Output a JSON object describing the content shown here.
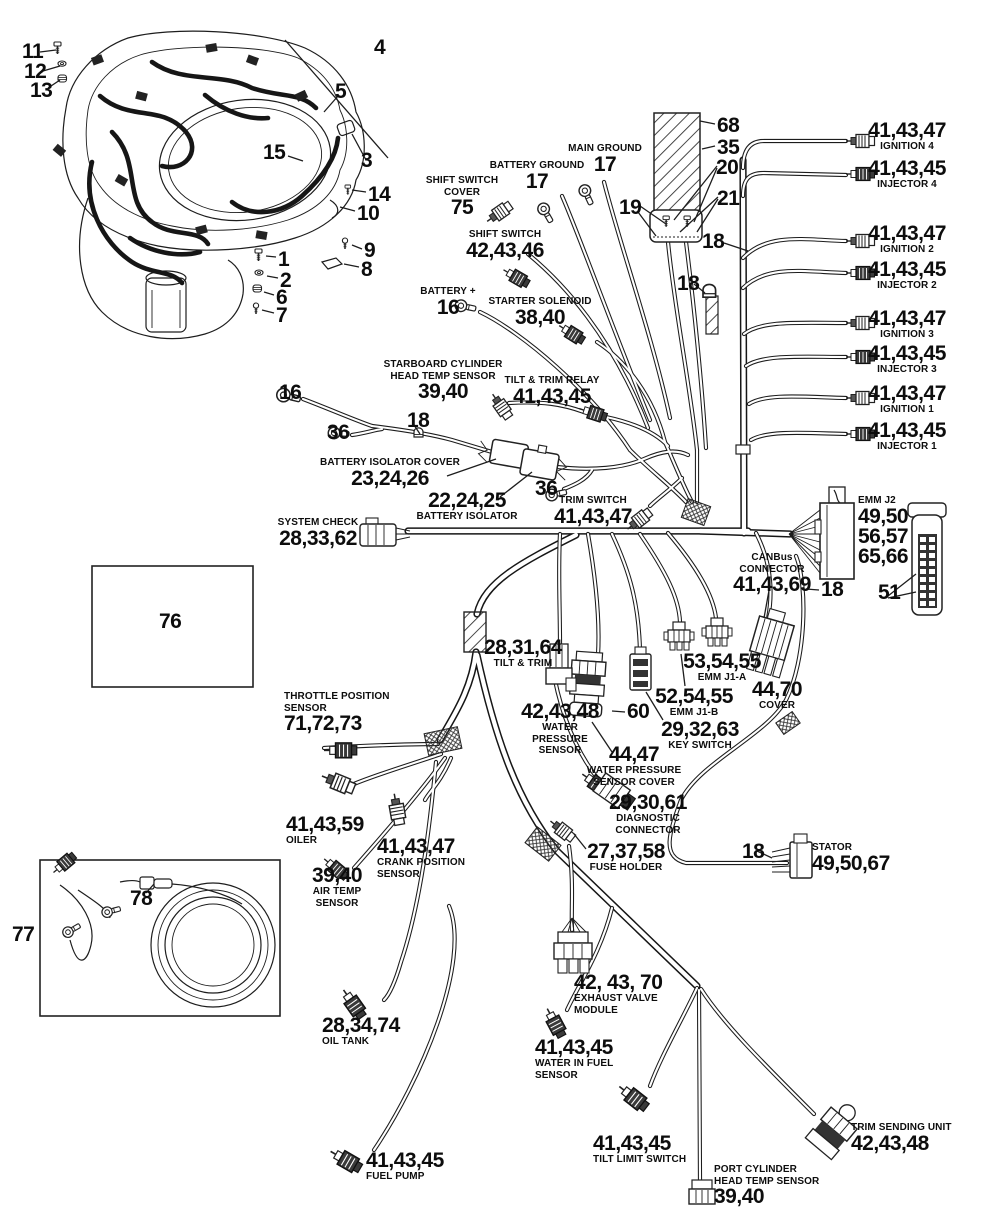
{
  "diagram": {
    "kind": "outboard-engine-electrical-harness-parts-diagram",
    "colors": {
      "ink": "#1a1a1a",
      "paper": "#ffffff"
    }
  },
  "callouts": [
    {
      "name": "bolt-11",
      "x": 22,
      "y": 42,
      "align": "left",
      "num": "11"
    },
    {
      "name": "washer-12",
      "x": 24,
      "y": 62,
      "align": "left",
      "num": "12"
    },
    {
      "name": "grommet-13",
      "x": 30,
      "y": 81,
      "align": "left",
      "num": "13"
    },
    {
      "name": "assembly-4",
      "x": 374,
      "y": 38,
      "align": "left",
      "num": "4"
    },
    {
      "name": "cowl-5",
      "x": 335,
      "y": 82,
      "align": "left",
      "num": "5"
    },
    {
      "name": "harness-15",
      "x": 263,
      "y": 143,
      "align": "left",
      "num": "15"
    },
    {
      "name": "mount-3",
      "x": 361,
      "y": 151,
      "align": "left",
      "num": "3"
    },
    {
      "name": "bracket-14",
      "x": 368,
      "y": 185,
      "align": "left",
      "num": "14"
    },
    {
      "name": "hook-10",
      "x": 357,
      "y": 204,
      "align": "left",
      "num": "10"
    },
    {
      "name": "screw-9",
      "x": 364,
      "y": 241,
      "align": "left",
      "num": "9"
    },
    {
      "name": "clip-8",
      "x": 361,
      "y": 260,
      "align": "left",
      "num": "8"
    },
    {
      "name": "bolt-1",
      "x": 278,
      "y": 250,
      "align": "left",
      "num": "1"
    },
    {
      "name": "washer-2",
      "x": 280,
      "y": 271,
      "align": "left",
      "num": "2"
    },
    {
      "name": "grommet-6",
      "x": 276,
      "y": 288,
      "align": "left",
      "num": "6"
    },
    {
      "name": "screw-7",
      "x": 276,
      "y": 306,
      "align": "left",
      "num": "7"
    },
    {
      "name": "shift-switch-cover",
      "x": 462,
      "y": 175,
      "align": "center",
      "above": [
        "SHIFT SWITCH",
        "COVER"
      ],
      "num": "75"
    },
    {
      "name": "battery-ground",
      "x": 537,
      "y": 160,
      "align": "center",
      "above": [
        "BATTERY GROUND"
      ],
      "num": "17"
    },
    {
      "name": "main-ground",
      "x": 605,
      "y": 143,
      "align": "center",
      "above": [
        "MAIN GROUND"
      ],
      "num": "17"
    },
    {
      "name": "sleeve-68",
      "x": 717,
      "y": 116,
      "align": "left",
      "num": "68"
    },
    {
      "name": "sleeve-35",
      "x": 717,
      "y": 138,
      "align": "left",
      "num": "35"
    },
    {
      "name": "bolt-20",
      "x": 716,
      "y": 158,
      "align": "left",
      "num": "20"
    },
    {
      "name": "nut-21",
      "x": 717,
      "y": 189,
      "align": "left",
      "num": "21"
    },
    {
      "name": "wires-19",
      "x": 619,
      "y": 198,
      "align": "left",
      "num": "19"
    },
    {
      "name": "clamp-18a",
      "x": 702,
      "y": 232,
      "align": "left",
      "num": "18"
    },
    {
      "name": "clamp-18b",
      "x": 677,
      "y": 274,
      "align": "left",
      "num": "18"
    },
    {
      "name": "shift-switch",
      "x": 505,
      "y": 229,
      "align": "center",
      "above": [
        "SHIFT SWITCH"
      ],
      "num": "42,43,46"
    },
    {
      "name": "battery-plus",
      "x": 448,
      "y": 286,
      "align": "center",
      "above": [
        "BATTERY +"
      ],
      "num": "16"
    },
    {
      "name": "starter-solenoid",
      "x": 540,
      "y": 296,
      "align": "center",
      "above": [
        "STARTER SOLENOID"
      ],
      "num": "38,40"
    },
    {
      "name": "ignition-4",
      "x": 907,
      "y": 121,
      "align": "center",
      "num": "41,43,47",
      "below": [
        "IGNITION 4"
      ]
    },
    {
      "name": "injector-4",
      "x": 907,
      "y": 159,
      "align": "center",
      "num": "41,43,45",
      "below": [
        "INJECTOR 4"
      ]
    },
    {
      "name": "ignition-2",
      "x": 907,
      "y": 224,
      "align": "center",
      "num": "41,43,47",
      "below": [
        "IGNITION 2"
      ]
    },
    {
      "name": "injector-2",
      "x": 907,
      "y": 260,
      "align": "center",
      "num": "41,43,45",
      "below": [
        "INJECTOR 2"
      ]
    },
    {
      "name": "ignition-3",
      "x": 907,
      "y": 309,
      "align": "center",
      "num": "41,43,47",
      "below": [
        "IGNITION 3"
      ]
    },
    {
      "name": "injector-3",
      "x": 907,
      "y": 344,
      "align": "center",
      "num": "41,43,45",
      "below": [
        "INJECTOR 3"
      ]
    },
    {
      "name": "ignition-1",
      "x": 907,
      "y": 384,
      "align": "center",
      "num": "41,43,47",
      "below": [
        "IGNITION 1"
      ]
    },
    {
      "name": "injector-1",
      "x": 907,
      "y": 421,
      "align": "center",
      "num": "41,43,45",
      "below": [
        "INJECTOR 1"
      ]
    },
    {
      "name": "ring-16",
      "x": 279,
      "y": 383,
      "align": "left",
      "num": "16"
    },
    {
      "name": "ring-36a",
      "x": 327,
      "y": 423,
      "align": "left",
      "num": "36"
    },
    {
      "name": "clamp-18c",
      "x": 407,
      "y": 411,
      "align": "left",
      "num": "18"
    },
    {
      "name": "starboard-head-temp",
      "x": 443,
      "y": 359,
      "align": "center",
      "above": [
        "STARBOARD CYLINDER",
        "HEAD TEMP SENSOR"
      ],
      "num": "39,40"
    },
    {
      "name": "tilt-trim-relay",
      "x": 552,
      "y": 375,
      "align": "center",
      "above": [
        "TILT & TRIM RELAY"
      ],
      "num": "41,43,45"
    },
    {
      "name": "battery-isolator-cover",
      "x": 390,
      "y": 457,
      "align": "center",
      "above": [
        "BATTERY ISOLATOR COVER"
      ],
      "num": "23,24,26"
    },
    {
      "name": "battery-isolator",
      "x": 467,
      "y": 491,
      "align": "center",
      "num": "22,24,25",
      "below": [
        "BATTERY ISOLATOR"
      ]
    },
    {
      "name": "ring-36b",
      "x": 535,
      "y": 479,
      "align": "left",
      "num": "36"
    },
    {
      "name": "trim-switch",
      "x": 593,
      "y": 495,
      "align": "center",
      "above": [
        "TRIM SWITCH"
      ],
      "num": "41,43,47"
    },
    {
      "name": "system-check",
      "x": 318,
      "y": 517,
      "align": "center",
      "above": [
        "SYSTEM CHECK"
      ],
      "num": "28,33,62"
    },
    {
      "name": "emm-j2",
      "x": 858,
      "y": 495,
      "align": "left",
      "above": [
        "EMM J2"
      ],
      "nums": [
        "49,50",
        "56,57",
        "65,66"
      ]
    },
    {
      "name": "pin-block-51",
      "x": 878,
      "y": 583,
      "align": "left",
      "num": "51"
    },
    {
      "name": "canbus-connector",
      "x": 772,
      "y": 552,
      "align": "center",
      "above": [
        "CANBus",
        "CONNECTOR"
      ],
      "num": "41,43,69"
    },
    {
      "name": "clamp-18d",
      "x": 821,
      "y": 580,
      "align": "left",
      "num": "18"
    },
    {
      "name": "canbus-cover",
      "x": 777,
      "y": 680,
      "align": "center",
      "num": "44,70",
      "below": [
        "COVER"
      ]
    },
    {
      "name": "emm-j1a",
      "x": 722,
      "y": 652,
      "align": "center",
      "num": "53,54,55",
      "below": [
        "EMM J1-A"
      ]
    },
    {
      "name": "emm-j1b",
      "x": 694,
      "y": 687,
      "align": "center",
      "num": "52,54,55",
      "below": [
        "EMM J1-B"
      ]
    },
    {
      "name": "key-switch",
      "x": 700,
      "y": 720,
      "align": "center",
      "num": "29,32,63",
      "below": [
        "KEY SWITCH"
      ]
    },
    {
      "name": "tilt-trim-connector",
      "x": 523,
      "y": 638,
      "align": "center",
      "num": "28,31,64",
      "below": [
        "TILT & TRIM"
      ]
    },
    {
      "name": "water-pressure-sensor",
      "x": 560,
      "y": 702,
      "align": "center",
      "num": "42,43,48",
      "below": [
        "WATER",
        "PRESSURE",
        "SENSOR"
      ]
    },
    {
      "name": "grommet-60",
      "x": 627,
      "y": 702,
      "align": "left",
      "num": "60"
    },
    {
      "name": "water-pressure-sensor-cover",
      "x": 634,
      "y": 745,
      "align": "center",
      "num": "44,47",
      "below": [
        "WATER PRESSURE",
        "SENSOR COVER"
      ]
    },
    {
      "name": "diagnostic-connector",
      "x": 648,
      "y": 793,
      "align": "center",
      "num": "29,30,61",
      "below": [
        "DIAGNOSTIC",
        "CONNECTOR"
      ]
    },
    {
      "name": "fuse-holder",
      "x": 626,
      "y": 842,
      "align": "center",
      "num": "27,37,58",
      "below": [
        "FUSE HOLDER"
      ]
    },
    {
      "name": "clamp-18e",
      "x": 742,
      "y": 842,
      "align": "left",
      "num": "18"
    },
    {
      "name": "stator",
      "x": 812,
      "y": 842,
      "align": "left",
      "above": [
        "STATOR"
      ],
      "num": "49,50,67"
    },
    {
      "name": "inset-76",
      "x": 159,
      "y": 612,
      "align": "left",
      "num": "76"
    },
    {
      "name": "throttle-position-sensor",
      "x": 284,
      "y": 691,
      "align": "left",
      "above": [
        "THROTTLE POSITION",
        "SENSOR"
      ],
      "num": "71,72,73"
    },
    {
      "name": "oiler",
      "x": 286,
      "y": 815,
      "align": "left",
      "num": "41,43,59",
      "below": [
        "OILER"
      ]
    },
    {
      "name": "crank-position-sensor",
      "x": 377,
      "y": 837,
      "align": "left",
      "num": "41,43,47",
      "below": [
        "CRANK POSITION",
        "SENSOR"
      ]
    },
    {
      "name": "air-temp-sensor",
      "x": 337,
      "y": 866,
      "align": "center",
      "num": "39,40",
      "below": [
        "AIR TEMP",
        "SENSOR"
      ]
    },
    {
      "name": "inset-77",
      "x": 12,
      "y": 925,
      "align": "left",
      "num": "77"
    },
    {
      "name": "inline-78",
      "x": 130,
      "y": 889,
      "align": "left",
      "num": "78"
    },
    {
      "name": "oil-tank",
      "x": 322,
      "y": 1016,
      "align": "left",
      "num": "28,34,74",
      "below": [
        "OIL TANK"
      ]
    },
    {
      "name": "exhaust-valve-module",
      "x": 574,
      "y": 973,
      "align": "left",
      "num": "42, 43, 70",
      "below": [
        "EXHAUST VALVE",
        "MODULE"
      ]
    },
    {
      "name": "water-in-fuel-sensor",
      "x": 535,
      "y": 1038,
      "align": "left",
      "num": "41,43,45",
      "below": [
        "WATER IN FUEL",
        "SENSOR"
      ]
    },
    {
      "name": "fuel-pump",
      "x": 366,
      "y": 1151,
      "align": "left",
      "num": "41,43,45",
      "below": [
        "FUEL PUMP"
      ]
    },
    {
      "name": "tilt-limit-switch",
      "x": 593,
      "y": 1134,
      "align": "left",
      "num": "41,43,45",
      "below": [
        "TILT LIMIT SWITCH"
      ]
    },
    {
      "name": "trim-sending-unit",
      "x": 851,
      "y": 1122,
      "align": "left",
      "above": [
        "TRIM SENDING UNIT"
      ],
      "num": "42,43,48"
    },
    {
      "name": "port-cylinder-head-temp",
      "x": 714,
      "y": 1164,
      "align": "left",
      "above": [
        "PORT CYLINDER",
        "HEAD TEMP SENSOR"
      ],
      "num": "39,40"
    }
  ]
}
